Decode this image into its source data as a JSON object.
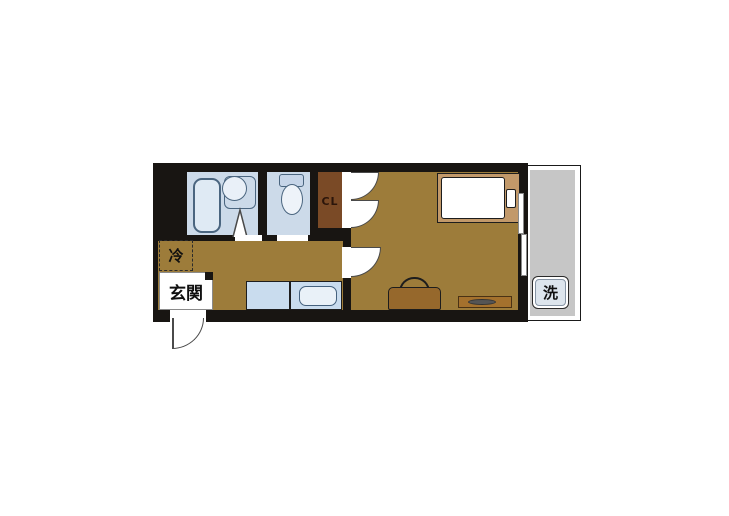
{
  "labels": {
    "entrance": "玄関",
    "refrigerator": "冷",
    "closet": "CL",
    "washer": "洗"
  },
  "colors": {
    "wall": "#181512",
    "flooring": "#9d7c3a",
    "closet": "#7a4a26",
    "wet_area": "#ccdae9",
    "balcony": "#c6c6c6",
    "kitchen_counter": "#c9dcee",
    "bed_frame": "#c2996a",
    "bag": "#96682c",
    "fixture_outline": "#4a657f"
  }
}
